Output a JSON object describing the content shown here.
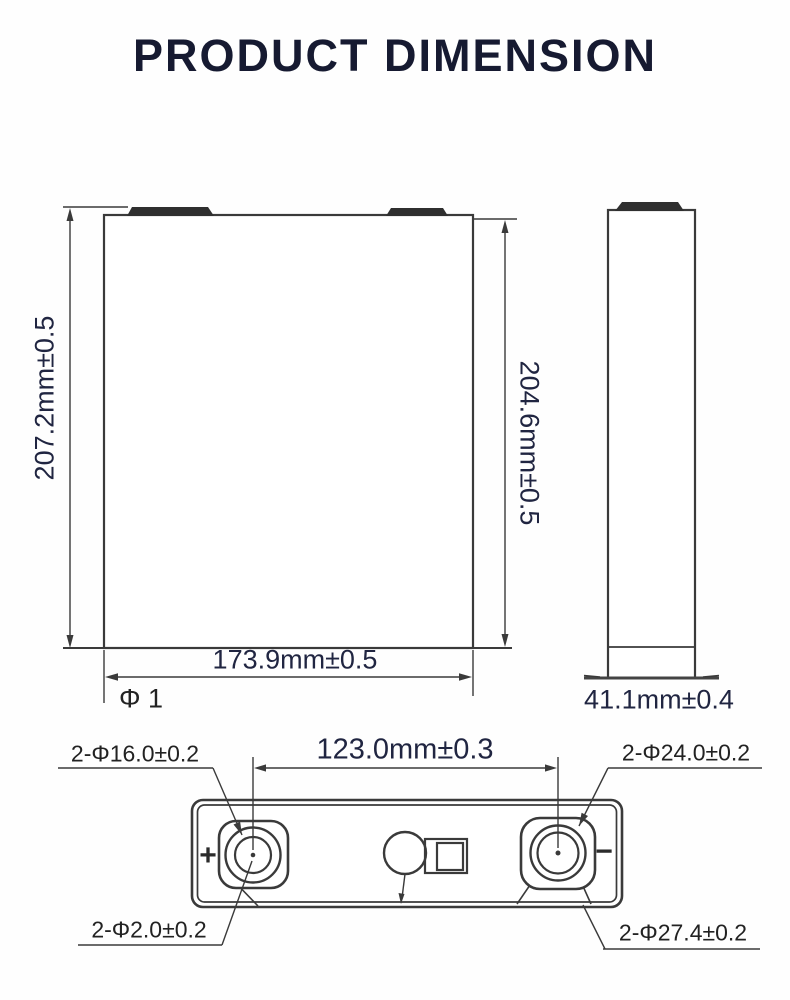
{
  "title": "PRODUCT DIMENSION",
  "front_view": {
    "height_total": "207.2mm±0.5",
    "height_body": "204.6mm±0.5",
    "width": "173.9mm±0.5",
    "corner_note": "Φ 1"
  },
  "side_view": {
    "thickness": "41.1mm±0.4"
  },
  "terminal_view": {
    "pitch": "123.0mm±0.3",
    "label_top_left": "2-Φ16.0±0.2",
    "label_top_right": "2-Φ24.0±0.2",
    "label_bottom_left": "2-Φ2.0±0.2",
    "label_bottom_right": "2-Φ27.4±0.2",
    "positive_symbol": "+",
    "negative_symbol": "−"
  },
  "colors": {
    "title_text": "#161a31",
    "dimension_text": "#202541",
    "label_text": "#222222",
    "line_art": "#3a3a3a"
  }
}
